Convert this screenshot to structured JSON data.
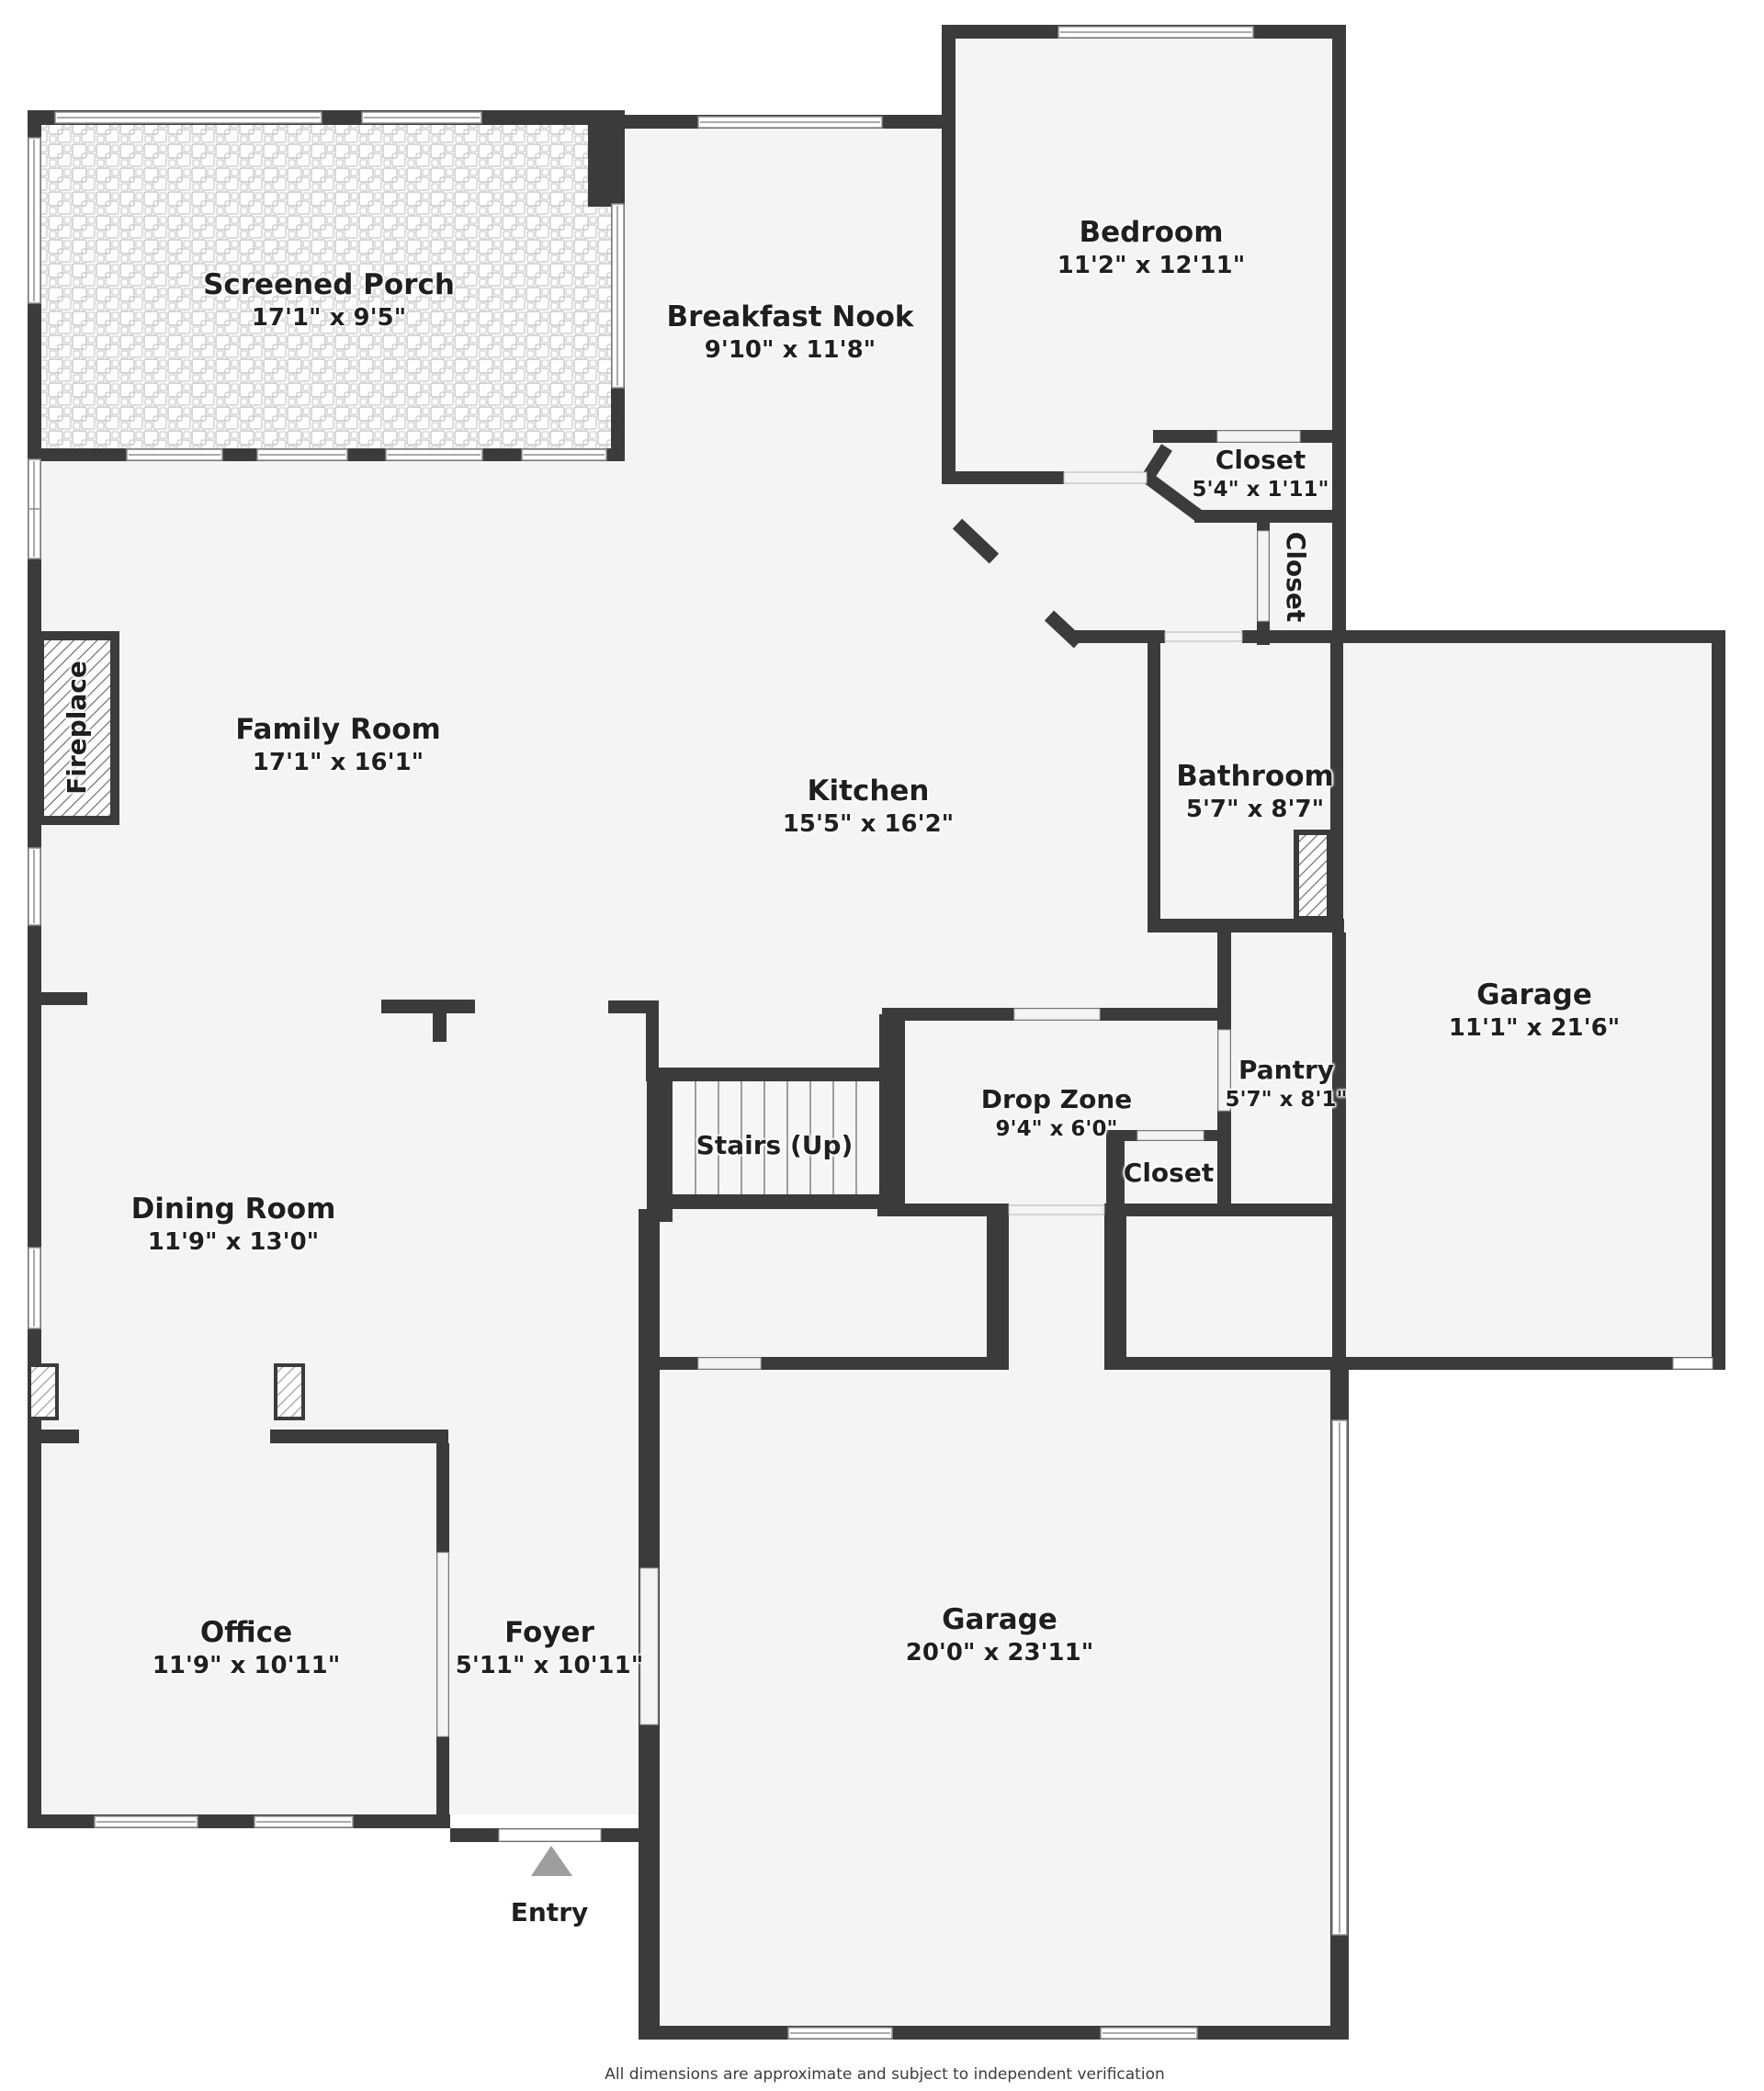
{
  "colors": {
    "wall": "#3b3b3b",
    "floor": "#f4f4f4",
    "page": "#ffffff",
    "text": "#1f1f1f",
    "entry_arrow": "#9e9e9e"
  },
  "rooms": [
    {
      "id": "screened_porch",
      "name": "Screened Porch",
      "dims": "17'1\" x 9'5\""
    },
    {
      "id": "breakfast_nook",
      "name": "Breakfast Nook",
      "dims": "9'10\" x 11'8\""
    },
    {
      "id": "bedroom",
      "name": "Bedroom",
      "dims": "11'2\" x 12'11\""
    },
    {
      "id": "bedroom_closet",
      "name": "Closet",
      "dims": "5'4\" x 1'11\""
    },
    {
      "id": "hall_closet_upper",
      "name": "Closet",
      "dims": ""
    },
    {
      "id": "family_room",
      "name": "Family Room",
      "dims": "17'1\" x 16'1\""
    },
    {
      "id": "kitchen",
      "name": "Kitchen",
      "dims": "15'5\" x 16'2\""
    },
    {
      "id": "bathroom",
      "name": "Bathroom",
      "dims": "5'7\" x 8'7\""
    },
    {
      "id": "garage_side",
      "name": "Garage",
      "dims": "11'1\" x 21'6\""
    },
    {
      "id": "fireplace",
      "name": "Fireplace",
      "dims": ""
    },
    {
      "id": "dining_room",
      "name": "Dining Room",
      "dims": "11'9\" x 13'0\""
    },
    {
      "id": "stairs",
      "name": "Stairs (Up)",
      "dims": ""
    },
    {
      "id": "drop_zone",
      "name": "Drop Zone",
      "dims": "9'4\" x 6'0\""
    },
    {
      "id": "pantry",
      "name": "Pantry",
      "dims": "5'7\" x 8'1\""
    },
    {
      "id": "hall_closet_lower",
      "name": "Closet",
      "dims": ""
    },
    {
      "id": "office",
      "name": "Office",
      "dims": "11'9\" x 10'11\""
    },
    {
      "id": "foyer",
      "name": "Foyer",
      "dims": "5'11\" x 10'11\""
    },
    {
      "id": "garage_main",
      "name": "Garage",
      "dims": "20'0\" x 23'11\""
    },
    {
      "id": "entry",
      "name": "Entry",
      "dims": ""
    }
  ],
  "footer": {
    "disclaimer": "All dimensions are approximate and subject to independent verification"
  }
}
